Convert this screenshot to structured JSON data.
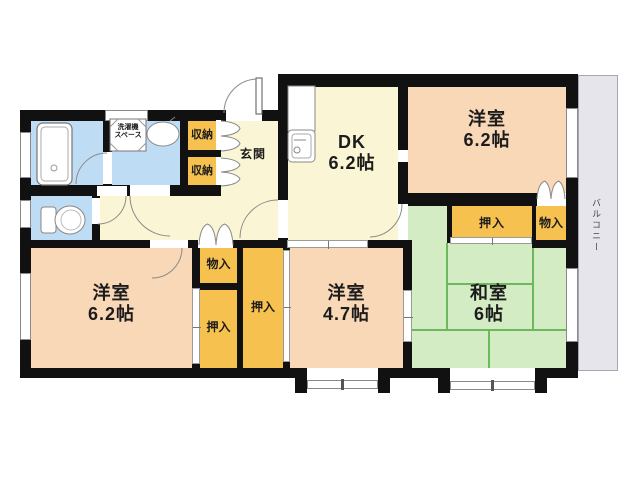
{
  "title": "apartment-floorplan",
  "rooms": {
    "dk": {
      "name": "DK",
      "size": "6.2帖"
    },
    "western_top": {
      "name": "洋室",
      "size": "6.2帖"
    },
    "western_left": {
      "name": "洋室",
      "size": "6.2帖"
    },
    "western_center": {
      "name": "洋室",
      "size": "4.7帖"
    },
    "japanese": {
      "name": "和室",
      "size": "6帖"
    },
    "entrance": {
      "name": "玄関"
    },
    "balcony": {
      "name": "バルコニー"
    },
    "laundry": {
      "line1": "洗濯機",
      "line2": "スペース"
    }
  },
  "closets": {
    "shunou_top": "収納",
    "shunou_bottom": "収納",
    "oshiire_top": "押入",
    "monoire_top": "物入",
    "monoire_mid": "物入",
    "oshiire_left": "押入",
    "oshiire_center": "押入"
  },
  "colors": {
    "wall": "#111111",
    "western_room": "#f9d8b8",
    "dk_hall": "#faf6d5",
    "wet_area": "#bfdcf5",
    "tatami": "#d4ecc4",
    "tatami_line": "#6cb85c",
    "closet": "#f6c14e",
    "balcony": "#e7e5ec"
  }
}
